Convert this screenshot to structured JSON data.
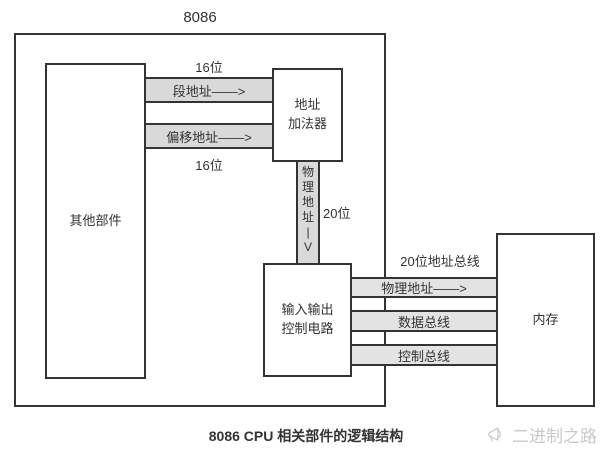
{
  "diagram": {
    "cpu_label": "8086",
    "boxes": {
      "other": "其他部件",
      "adder": {
        "line1": "地址",
        "line2": "加法器"
      },
      "io": {
        "line1": "输入输出",
        "line2": "控制电路"
      },
      "memory": "内存"
    },
    "buses": {
      "segment_band": "段地址——>",
      "offset_band": "偏移地址——>",
      "bits16_top": "16位",
      "bits16_bottom": "16位",
      "physical_vertical": "物理地址",
      "arrow_stem": "|",
      "arrow_head": "V",
      "bits20": "20位",
      "address_bus_label": "20位地址总线",
      "physical_band": "物理地址——>",
      "data_band": "数据总线",
      "control_band": "控制总线"
    },
    "caption": "8086 CPU 相关部件的逻辑结构",
    "watermark": "二进制之路",
    "colors": {
      "line": "#333333",
      "band_fill": "#d9d9d9",
      "band_fill_light": "#e3e3e3",
      "watermark": "#c9c9c9",
      "text": "#333333"
    }
  }
}
